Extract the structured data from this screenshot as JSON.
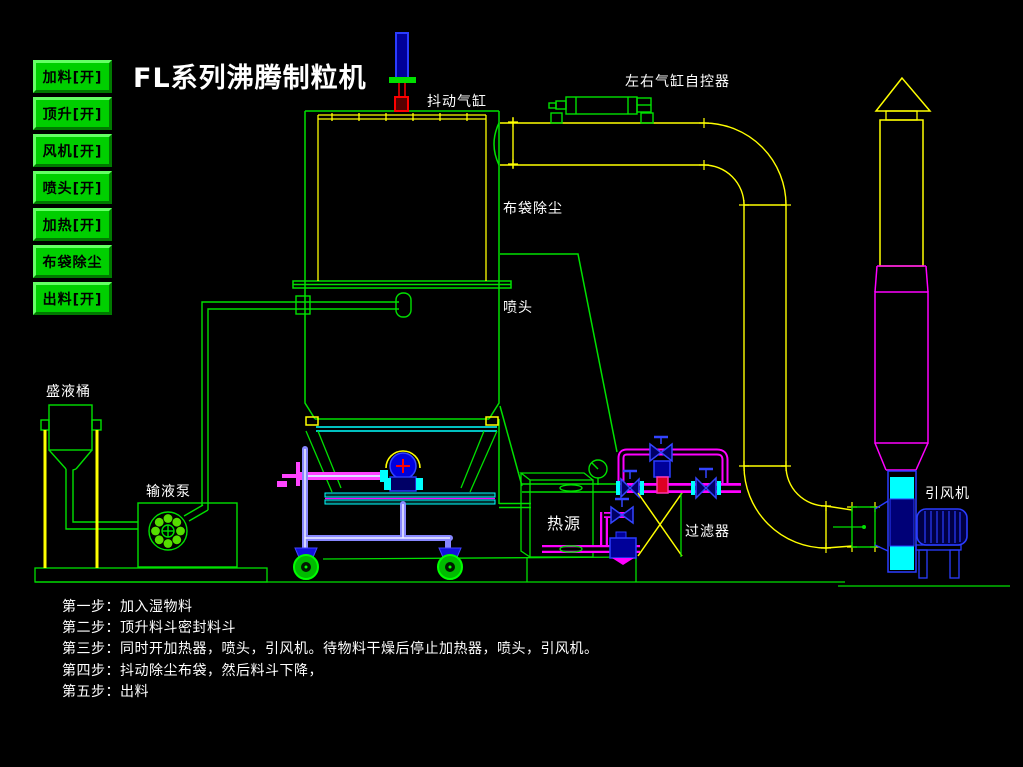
{
  "title": "FL系列沸腾制粒机",
  "control_panel": {
    "buttons": [
      {
        "label": "加料[开]"
      },
      {
        "label": "顶升[开]"
      },
      {
        "label": "风机[开]"
      },
      {
        "label": "喷头[开]"
      },
      {
        "label": "加热[开]"
      },
      {
        "label": "布袋除尘"
      },
      {
        "label": "出料[开]"
      }
    ]
  },
  "diagram_labels": {
    "shake_cylinder": "抖动气缸",
    "lr_cylinder_controller": "左右气缸自控器",
    "bag_dust": "布袋除尘",
    "spray_head": "喷头",
    "liquid_tank": "盛液桶",
    "liquid_pump": "输液泵",
    "heat_source": "热源",
    "filter": "过滤器",
    "fan": "引风机"
  },
  "steps": [
    "第一步：加入湿物料",
    "第二步：顶升料斗密封料斗",
    "第三步：同时开加热器，喷头，引风机。待物料干燥后停止加热器，喷头，引风机。",
    "第四步：抖动除尘布袋，然后料斗下降，",
    "第五步：出料"
  ],
  "palette": {
    "background": "#000000",
    "button_green": "#00cf00",
    "cad_green": "#00e000",
    "duct_yellow": "#ffff00",
    "pipe_magenta": "#ff00ff",
    "cyan": "#00ffff",
    "bright_blue": "#2a3cff",
    "dark_blue_fill": "#000088",
    "red": "#ff0000",
    "trolley_blue": "#8888ff",
    "text_white": "#ffffff"
  }
}
